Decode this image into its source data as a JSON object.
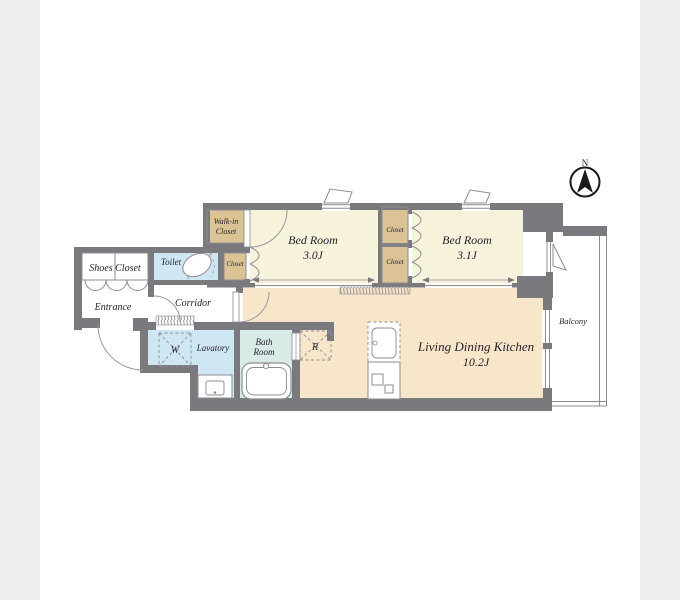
{
  "compass": {
    "north_label": "N"
  },
  "rooms": {
    "shoes_closet": "Shoes Closet",
    "entrance": "Entrance",
    "toilet": "Toilet",
    "corridor": "Corridor",
    "walk_in_closet_line1": "Walk-in",
    "walk_in_closet_line2": "Closet",
    "closet_hall": "Closet",
    "bedroom1_name": "Bed Room",
    "bedroom1_size": "3.0J",
    "closet_between_top": "Closet",
    "closet_between_bottom": "Closet",
    "bedroom2_name": "Bed Room",
    "bedroom2_size": "3.1J",
    "washer": "W",
    "lavatory": "Lavatory",
    "bath_line1": "Bath",
    "bath_line2": "Room",
    "refrigerator": "R",
    "ldk_name": "Living Dining Kitchen",
    "ldk_size": "10.2J",
    "balcony": "Balcony"
  },
  "colors": {
    "wall": "#7a7a7e",
    "bedroom": "#f7f2dc",
    "closet": "#dcc396",
    "ldk": "#f8e6ca",
    "water": "#cfe7f2",
    "bath": "#d9ebe6",
    "line": "#8c8c90",
    "text": "#23232b",
    "compass": "#1a1a1a",
    "side_strip": "#efefef"
  }
}
